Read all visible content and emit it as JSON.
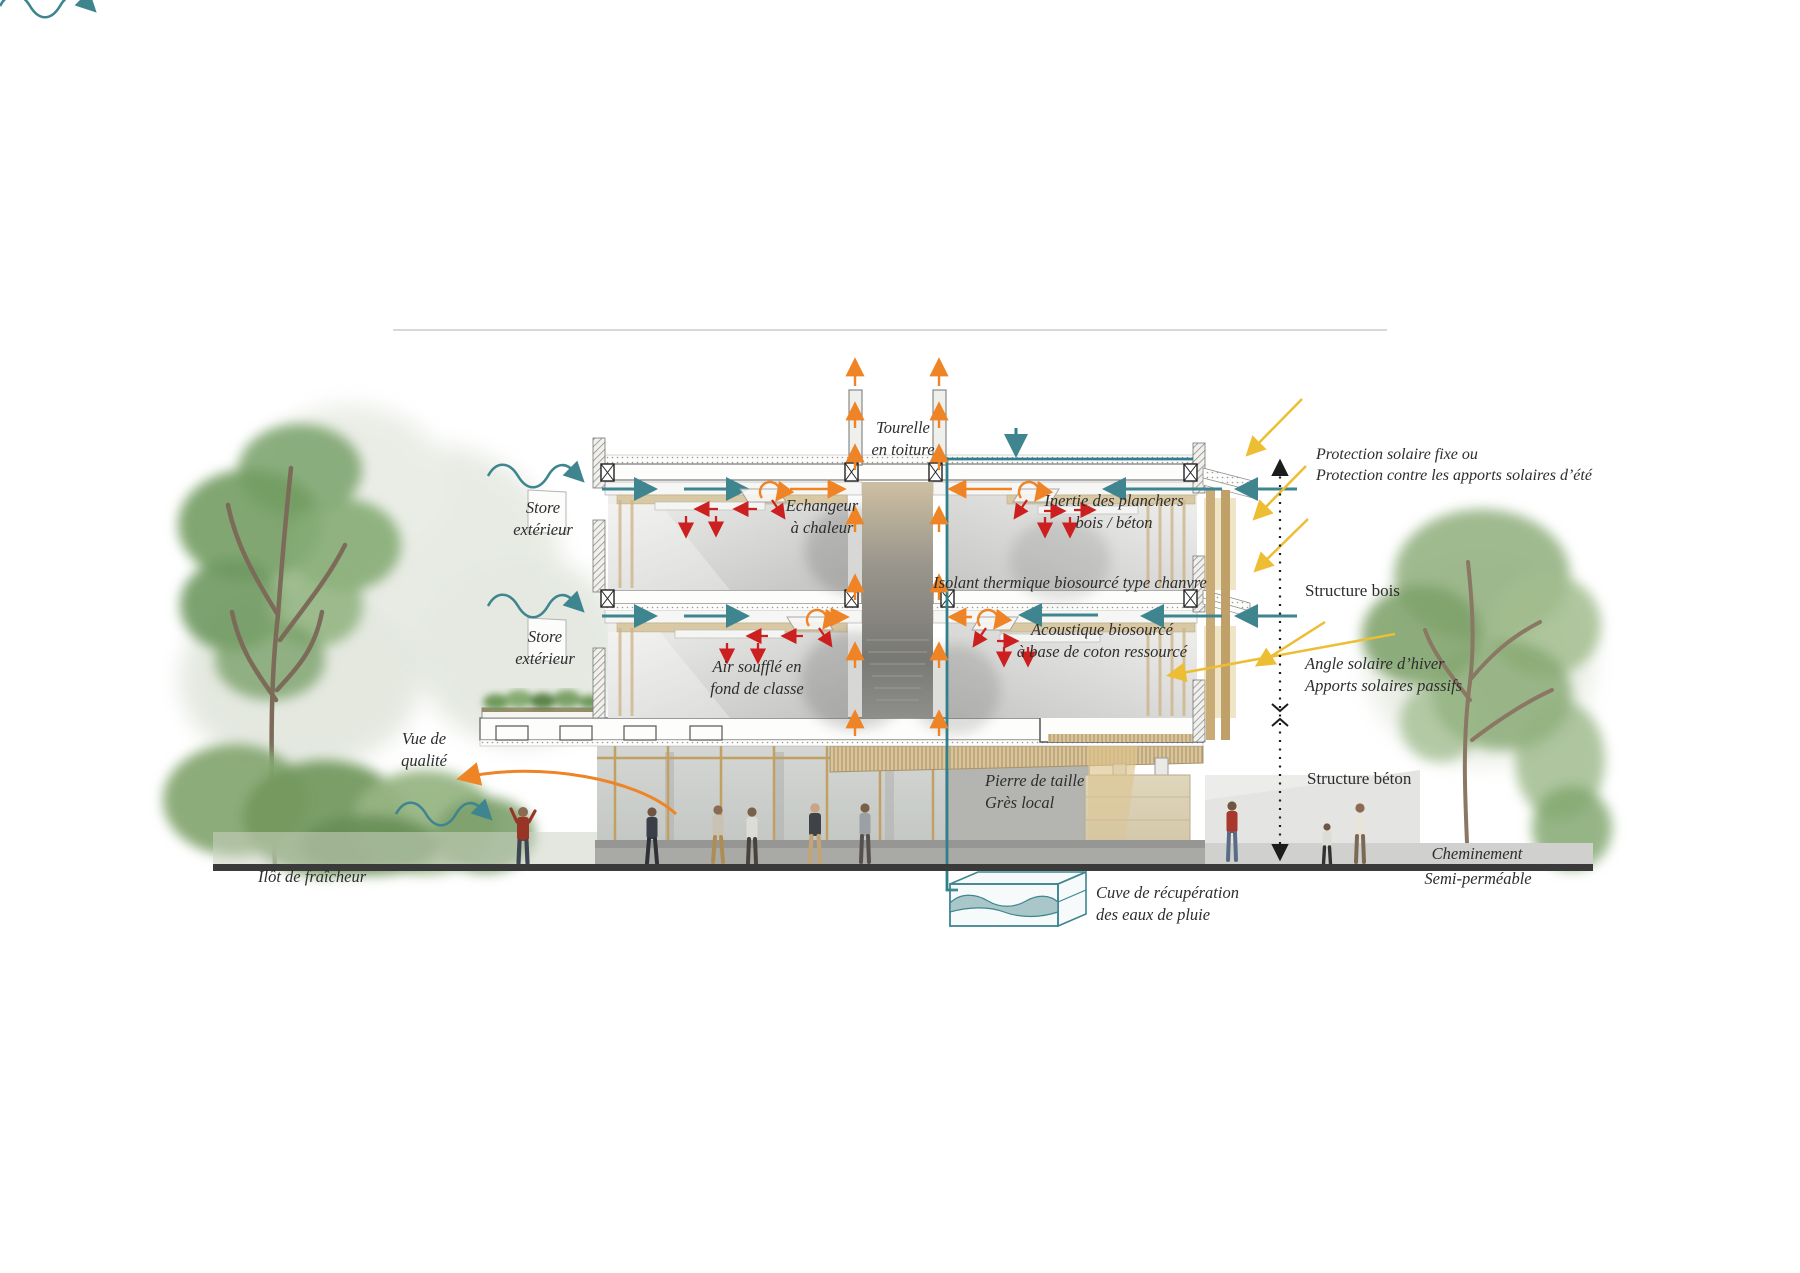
{
  "palette": {
    "teal": "#3E858F",
    "orange": "#EE8425",
    "red": "#CC1F1F",
    "sun_yellow": "#EDBE33",
    "ground_line": "#3A3A3A",
    "text": "#2D2D2D",
    "wood": "#C8AB76",
    "foliage": "#86A873"
  },
  "annotations": {
    "tourelle": "Tourelle\nen toiture",
    "store_exterieur_upper": "Store\nextérieur",
    "store_exterieur_lower": "Store\nextérieur",
    "echangeur": "Echangeur\nà chaleur",
    "inertie": "Inertie des planchers\nbois / béton",
    "isolant": "Isolant thermique biosourcé type chanvre",
    "acoustique": "Acoustique biosourcé\nà base de coton ressourcé",
    "air_souffle": "Air soufflé en\nfond de classe",
    "vue_qualite": "Vue de\nqualité",
    "ilot_fraicheur": "Ilôt de fraîcheur",
    "pierre_taille": "Pierre de taille\nGrès local",
    "cuve": "Cuve de récupération\ndes eaux de pluie",
    "protection_solaire": "Protection solaire fixe ou\nProtection contre les apports solaires d’été",
    "structure_bois": "Structure bois",
    "angle_solaire": "Angle solaire d’hiver\nApports solaires passifs",
    "structure_beton": "Structure béton",
    "cheminement_line1": "Cheminement",
    "cheminement_line2": "Semi-perméable"
  }
}
